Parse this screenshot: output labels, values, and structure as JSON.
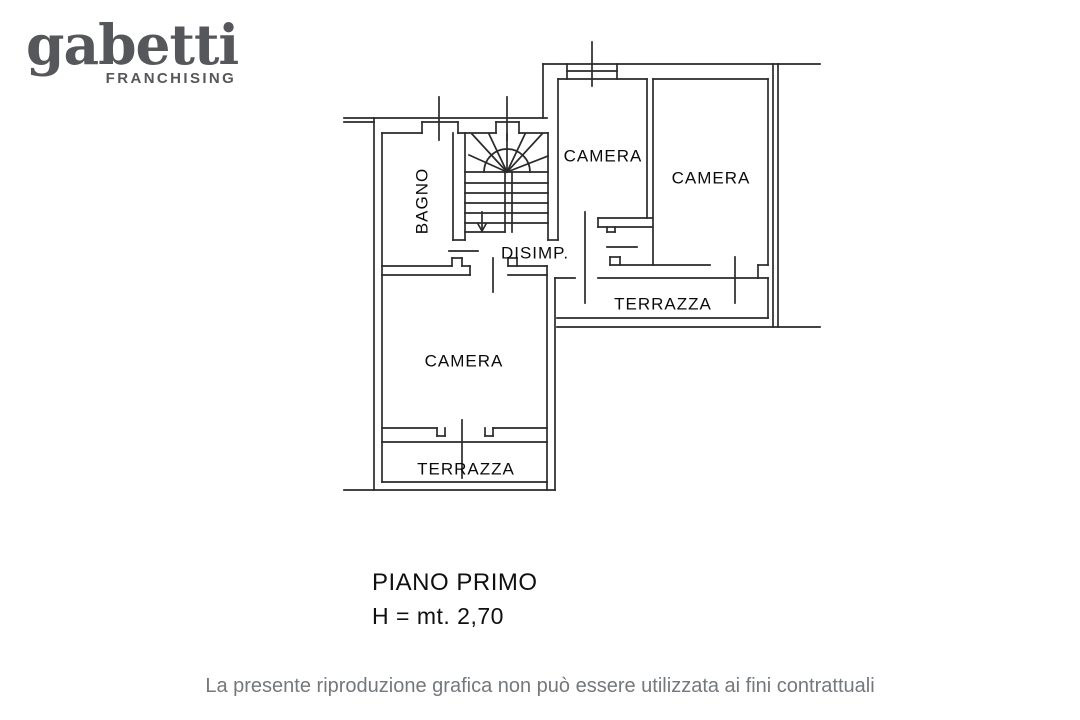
{
  "logo": {
    "brand": "gabetti",
    "subtitle": "FRANCHISING",
    "color": "#55575b"
  },
  "plan": {
    "line_color": "#2a2a2a",
    "rooms": [
      {
        "id": "bagno",
        "label": "BAGNO"
      },
      {
        "id": "camera-top",
        "label": "CAMERA"
      },
      {
        "id": "camera-right",
        "label": "CAMERA"
      },
      {
        "id": "camera-bottom",
        "label": "CAMERA"
      },
      {
        "id": "disimpegno",
        "label": "DISIMP."
      },
      {
        "id": "terrazza-right",
        "label": "TERRAZZA"
      },
      {
        "id": "terrazza-bottom",
        "label": "TERRAZZA"
      }
    ]
  },
  "caption": {
    "floor": "PIANO PRIMO",
    "height": "H = mt. 2,70"
  },
  "footer": {
    "disclaimer": "La presente riproduzione grafica non può essere utilizzata ai fini contrattuali",
    "color": "#74787c"
  }
}
